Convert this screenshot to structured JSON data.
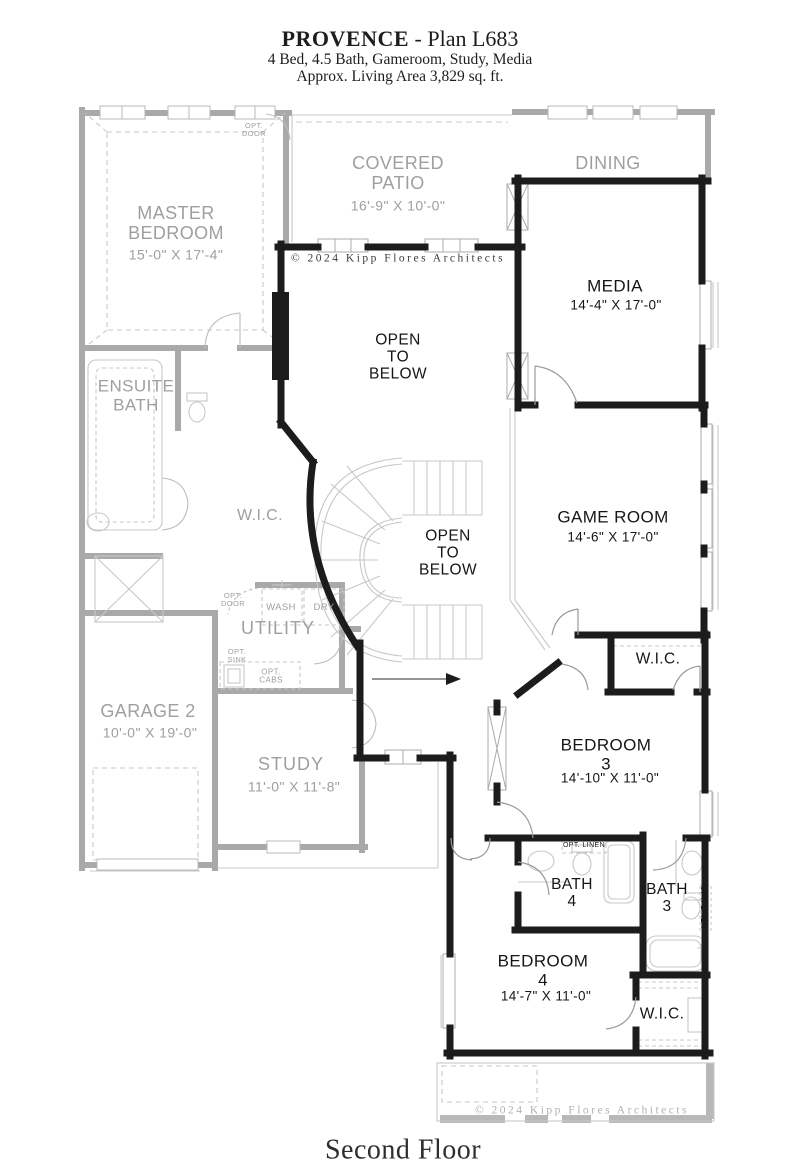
{
  "header": {
    "plan_name": "PROVENCE",
    "plan_suffix": " - Plan L683",
    "features": "4 Bed, 4.5 Bath, Gameroom, Study, Media",
    "area": "Approx. Living Area 3,829 sq. ft."
  },
  "footer": {
    "floor_label": "Second Floor"
  },
  "copyright": {
    "top": "© 2024 Kipp Flores Architects",
    "bottom": "© 2024 Kipp Flores Architects"
  },
  "colors": {
    "active_wall": "#1c1c1c",
    "ghost_wall": "#a9a9a9",
    "ghost_text": "#9f9f9f",
    "active_text": "#161616",
    "detail": "#c8c8c8"
  },
  "rooms": {
    "master": {
      "name": "MASTER\nBEDROOM",
      "dims": "15'-0\" X 17'-4\""
    },
    "patio": {
      "name": "COVERED\nPATIO",
      "dims": "16'-9\" X 10'-0\""
    },
    "dining": {
      "name": "DINING"
    },
    "media": {
      "name": "MEDIA",
      "dims": "14'-4\" X 17'-0\""
    },
    "open_below_upper": {
      "name": "OPEN\nTO\nBELOW"
    },
    "open_below_stair": {
      "name": "OPEN\nTO\nBELOW"
    },
    "ensuite": {
      "name": "ENSUITE\nBATH"
    },
    "wic_master": {
      "name": "W.I.C."
    },
    "utility": {
      "name": "UTILITY"
    },
    "game": {
      "name": "GAME ROOM",
      "dims": "14'-6\" X 17'-0\""
    },
    "wic_bed3": {
      "name": "W.I.C."
    },
    "bed3": {
      "name": "BEDROOM\n3",
      "dims": "14'-10\" X 11'-0\""
    },
    "garage": {
      "name": "GARAGE 2",
      "dims": "10'-0\" X 19'-0\""
    },
    "study": {
      "name": "STUDY",
      "dims": "11'-0\" X 11'-8\""
    },
    "bath4": {
      "name": "BATH\n4"
    },
    "bath3": {
      "name": "BATH\n3"
    },
    "bed4": {
      "name": "BEDROOM\n4",
      "dims": "14'-7\" X 11'-0\""
    },
    "wic_bed4": {
      "name": "W.I.C."
    }
  },
  "annotations": {
    "opt_door_master": "OPT.\nDOOR",
    "opt_door_utility": "OPT.\nDOOR",
    "wash": "WASH",
    "dry": "DRY",
    "opt_sink": "OPT.\nSINK",
    "opt_cabs": "OPT.\nCABS",
    "opt_linen_bath4": "OPT. LINEN",
    "opt_linen_bath3": "OPT. LINEN"
  }
}
